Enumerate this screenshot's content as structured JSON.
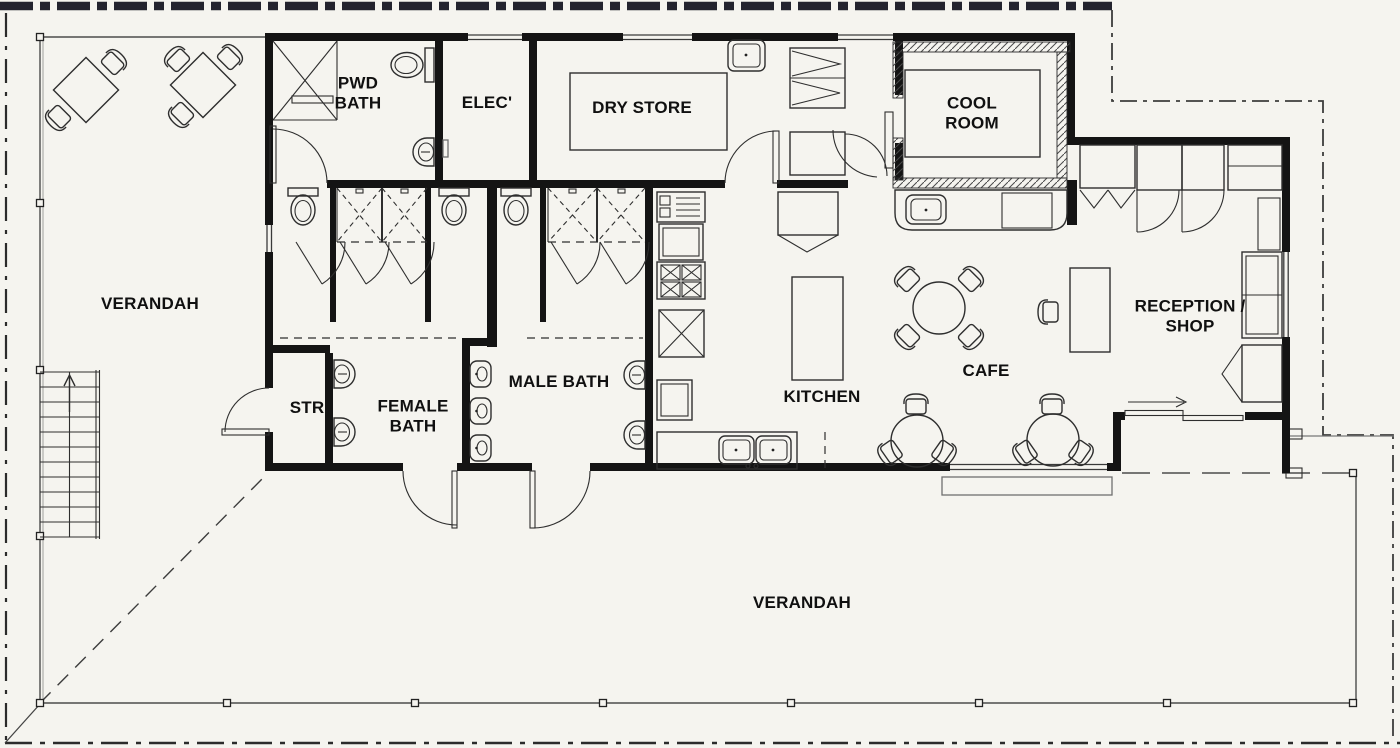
{
  "plan": {
    "rooms": {
      "verandah_left": {
        "label": "VERANDAH"
      },
      "pwd_bath": {
        "label": "PWD\nBATH"
      },
      "elec": {
        "label": "ELEC'"
      },
      "dry_store": {
        "label": "DRY STORE"
      },
      "cool_room": {
        "label": "COOL\nROOM"
      },
      "str": {
        "label": "STR"
      },
      "female_bath": {
        "label": "FEMALE\nBATH"
      },
      "male_bath": {
        "label": "MALE BATH"
      },
      "kitchen": {
        "label": "KITCHEN"
      },
      "cafe": {
        "label": "CAFE"
      },
      "reception_shop": {
        "label": "RECEPTION /\nSHOP"
      },
      "verandah_bottom": {
        "label": "VERANDAH"
      }
    },
    "colors": {
      "background": "#f5f4ef",
      "wall": "#141414",
      "line": "#2e2e2e",
      "muted": "#6f6f6f",
      "boundary": "#23232e",
      "text": "#101010"
    }
  }
}
